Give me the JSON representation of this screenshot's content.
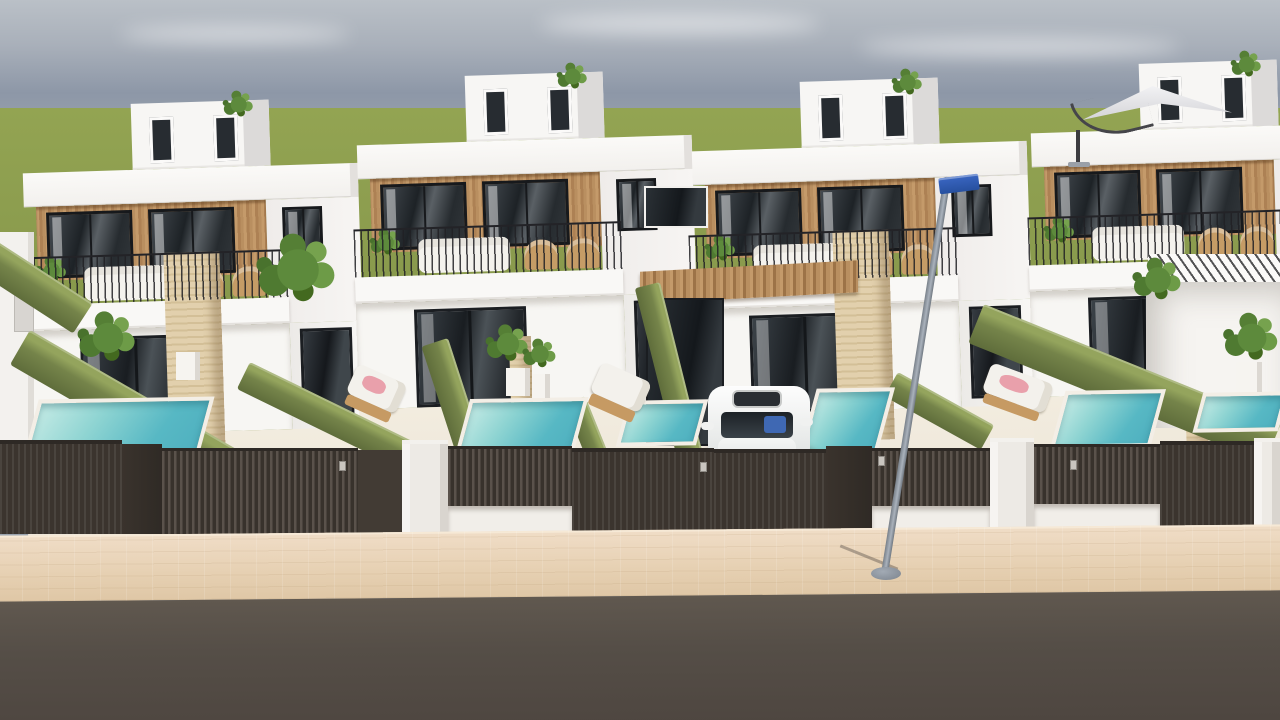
{
  "scene": {
    "description": "3D exterior render of a row of modern white townhouses with wood-slat facades, private plunge pools, olive-green hedge dividers, dark slatted street fence, beige paver sidewalk and asphalt road",
    "colors": {
      "sky_top": "#bac0c7",
      "sky_mid": "#8d97a7",
      "sky_low": "#a6adb5",
      "grass": "#8b9c4e",
      "wall_white": "#f8f7f5",
      "wood_cladding": "#b98f60",
      "window_glass": "#23282d",
      "window_frame": "#17191c",
      "hedge_green": "#74834a",
      "pool_water_light": "#abdfda",
      "pool_water_deep": "#57b7c3",
      "pool_coping": "#f3eee6",
      "travertine": "#dfcca8",
      "patio_floor": "#efe8dc",
      "fence_dark": "#3b342e",
      "fence_slat": "#5a524b",
      "gate_pillar_white": "#edeae5",
      "sidewalk": "#e6d0b2",
      "road": "#554e47",
      "lamp_pole": "#939ba6",
      "street_sign_blue": "#2e5cad",
      "car_white": "#f2f3f2",
      "lounger_cushion": "#f3f1ec",
      "lounger_wood": "#c69a63",
      "towel_pink": "#e9a0ab",
      "umbrella_canopy": "#e8e8ea"
    },
    "clouds": [
      {
        "l": 120,
        "t": 26,
        "w": 230,
        "h": 16
      },
      {
        "l": 540,
        "t": 14,
        "w": 280,
        "h": 20
      },
      {
        "l": 860,
        "t": 38,
        "w": 320,
        "h": 18
      }
    ],
    "houses": [
      {
        "id": "house-1",
        "left": 28,
        "top": 102,
        "pillar": "big"
      },
      {
        "id": "house-2",
        "left": 362,
        "top": 74,
        "pillar": "small"
      },
      {
        "id": "house-3",
        "left": 697,
        "top": 80,
        "pillar": "big"
      },
      {
        "id": "house-4",
        "left": 1036,
        "top": 62,
        "pillar": "small"
      }
    ],
    "hedges": [
      {
        "name": "hedge-far-left",
        "l": -8,
        "t": 238,
        "len": 120,
        "th": 36,
        "rot": 33
      },
      {
        "name": "hedge-1",
        "l": 30,
        "t": 330,
        "len": 250,
        "th": 40,
        "rot": 30
      },
      {
        "name": "hedge-2",
        "l": 250,
        "t": 362,
        "len": 200,
        "th": 30,
        "rot": 26
      },
      {
        "name": "hedge-3",
        "l": 448,
        "t": 338,
        "len": 135,
        "th": 28,
        "rot": 72
      },
      {
        "name": "hedge-4",
        "l": 660,
        "t": 282,
        "len": 185,
        "th": 26,
        "rot": 76
      },
      {
        "name": "hedge-5",
        "l": 585,
        "t": 396,
        "len": 78,
        "th": 22,
        "rot": 68
      },
      {
        "name": "hedge-6",
        "l": 898,
        "t": 372,
        "len": 110,
        "th": 28,
        "rot": 29
      },
      {
        "name": "hedge-7",
        "l": 984,
        "t": 304,
        "len": 320,
        "th": 42,
        "rot": 22
      }
    ],
    "pools": [
      {
        "name": "pool-1",
        "l": 30,
        "t": 398,
        "w": 175,
        "h": 68
      },
      {
        "name": "pool-2",
        "l": 462,
        "t": 398,
        "w": 118,
        "h": 62
      },
      {
        "name": "pool-3",
        "l": 622,
        "t": 400,
        "w": 80,
        "h": 46
      },
      {
        "name": "pool-4",
        "l": 808,
        "t": 388,
        "w": 78,
        "h": 66
      },
      {
        "name": "pool-5",
        "l": 1058,
        "t": 390,
        "w": 100,
        "h": 58
      },
      {
        "name": "pool-6",
        "l": 1198,
        "t": 392,
        "w": 85,
        "h": 40
      }
    ],
    "loungers": [
      {
        "name": "sun-lounger-2",
        "l": 346,
        "t": 372,
        "w": 54,
        "h": 50,
        "rot": 24,
        "towel": true
      },
      {
        "name": "sun-lounger-3",
        "l": 590,
        "t": 370,
        "w": 54,
        "h": 52,
        "rot": 24,
        "towel": false
      },
      {
        "name": "sun-lounger-4",
        "l": 982,
        "t": 372,
        "w": 66,
        "h": 48,
        "rot": 20,
        "towel": true
      }
    ],
    "plants": [
      {
        "name": "palm-patio-1",
        "l": 100,
        "t": 330,
        "s": 1.9
      },
      {
        "name": "palm-patio-1b",
        "l": 290,
        "t": 262,
        "s": 2.6
      },
      {
        "name": "plant-pot-2a",
        "l": 500,
        "t": 336,
        "s": 1.4
      },
      {
        "name": "plant-pot-2b",
        "l": 532,
        "t": 346,
        "s": 1.1
      },
      {
        "name": "palm-balcony-right",
        "l": 1150,
        "t": 272,
        "s": 1.6
      },
      {
        "name": "palm-wall-right",
        "l": 1244,
        "t": 330,
        "s": 1.8
      }
    ],
    "pots": [
      {
        "name": "planter-1",
        "l": 176,
        "t": 352,
        "w": 24,
        "h": 28
      },
      {
        "name": "planter-2a",
        "l": 506,
        "t": 368,
        "w": 24,
        "h": 28
      },
      {
        "name": "planter-2b",
        "l": 532,
        "t": 374,
        "w": 18,
        "h": 24
      },
      {
        "name": "planter-right",
        "l": 1236,
        "t": 362,
        "w": 26,
        "h": 30
      }
    ],
    "fence_segments": [
      {
        "name": "gate-tall-1",
        "cls": "f-gate",
        "l": 0,
        "t": 440,
        "w": 122,
        "h": 94
      },
      {
        "name": "pillar-1",
        "cls": "f-pillar",
        "l": 122,
        "t": 444,
        "w": 40,
        "h": 90
      },
      {
        "name": "slat-fence-1",
        "cls": "f-slats",
        "l": 162,
        "t": 448,
        "w": 196,
        "h": 86
      },
      {
        "name": "wall-1",
        "cls": "f-wall",
        "l": 358,
        "t": 450,
        "w": 44,
        "h": 84
      },
      {
        "name": "white-pillar-1",
        "cls": "f-pwhite",
        "l": 402,
        "t": 440,
        "w": 46,
        "h": 94
      },
      {
        "name": "low-slats-1",
        "cls": "f-slats",
        "l": 448,
        "t": 446,
        "w": 124,
        "h": 62
      },
      {
        "name": "gate-tall-2",
        "cls": "f-gate",
        "l": 572,
        "t": 448,
        "w": 142,
        "h": 86
      },
      {
        "name": "gate-tall-3",
        "cls": "f-gate",
        "l": 714,
        "t": 449,
        "w": 112,
        "h": 85
      },
      {
        "name": "pillar-2",
        "cls": "f-pillar",
        "l": 826,
        "t": 446,
        "w": 46,
        "h": 88
      },
      {
        "name": "low-slats-2",
        "cls": "f-slats",
        "l": 872,
        "t": 448,
        "w": 118,
        "h": 60
      },
      {
        "name": "white-pillar-2",
        "cls": "f-pwhite",
        "l": 990,
        "t": 438,
        "w": 44,
        "h": 96
      },
      {
        "name": "low-slats-3",
        "cls": "f-slats",
        "l": 1034,
        "t": 444,
        "w": 126,
        "h": 62
      },
      {
        "name": "gate-tall-4",
        "cls": "f-gate",
        "l": 1160,
        "t": 441,
        "w": 94,
        "h": 93
      },
      {
        "name": "white-pillar-3",
        "cls": "f-pwhite",
        "l": 1254,
        "t": 438,
        "w": 26,
        "h": 96
      }
    ],
    "fence_bases": [
      {
        "l": 448,
        "t": 506,
        "w": 124,
        "h": 28
      },
      {
        "l": 872,
        "t": 506,
        "w": 118,
        "h": 28
      },
      {
        "l": 1034,
        "t": 504,
        "w": 126,
        "h": 30
      }
    ],
    "keypads": [
      {
        "l": 339,
        "t": 461
      },
      {
        "l": 700,
        "t": 462
      },
      {
        "l": 878,
        "t": 456
      },
      {
        "l": 1070,
        "t": 460
      }
    ]
  }
}
